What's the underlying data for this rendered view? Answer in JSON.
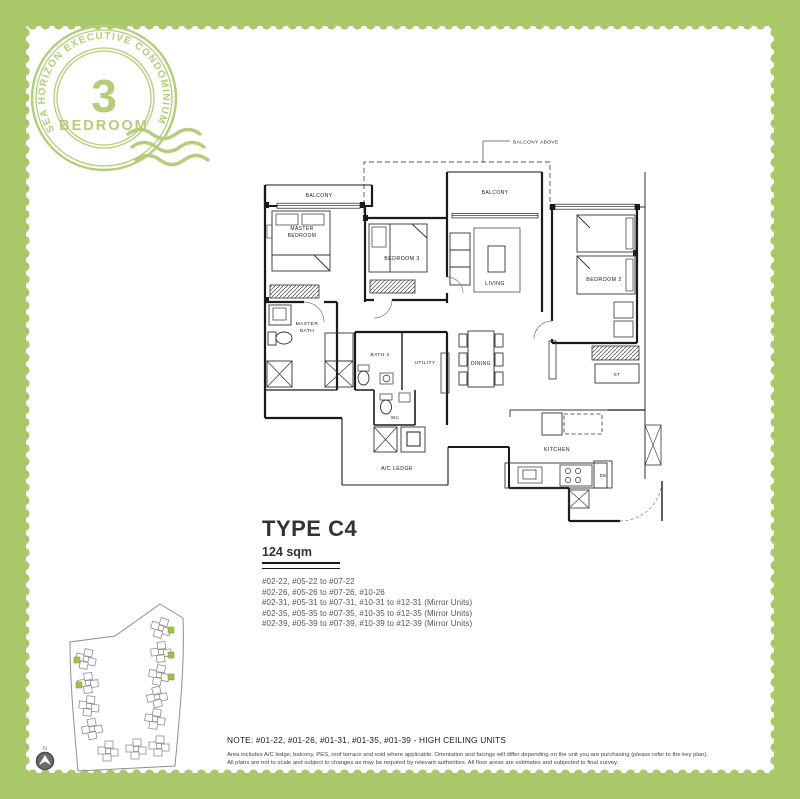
{
  "colors": {
    "frame_green": "#a9c869",
    "stamp_green": "#b3cd7a",
    "plan_line": "#1a1a1a",
    "site_highlight": "#9cc24d"
  },
  "stamp": {
    "arc_text": "SEA HORIZON EXECUTIVE CONDOMINIUM",
    "number": "3",
    "word": "BEDROOM"
  },
  "floorplan": {
    "labels": {
      "balcony_left": "BALCONY",
      "balcony_center": "BALCONY",
      "balcony_above": "BALCONY ABOVE",
      "master_l1": "MASTER",
      "master_l2": "BEDROOM",
      "bedroom3": "BEDROOM 3",
      "living": "LIVING",
      "bedroom2": "BEDROOM 2",
      "masterbath_l1": "MASTER",
      "masterbath_l2": "BATH",
      "bath2": "BATH 2",
      "utility": "UTILITY",
      "wc": "WC",
      "dining": "DINING",
      "st": "ST",
      "kitchen": "KITCHEN",
      "ac_ledge": "A/C  LEDGE",
      "db": "DB"
    }
  },
  "unit_info": {
    "type": "TYPE C4",
    "area": "124 sqm",
    "units": [
      "#02-22, #05-22 to #07-22",
      "#02-26, #05-26 to #07-26, #10-26",
      "#02-31, #05-31 to #07-31, #10-31 to #12-31 (Mirror Units)",
      "#02-35, #05-35 to #07-35, #10-35 to #12-35 (Mirror Units)",
      "#02-39, #05-39 to #07-39, #10-39 to #12-39 (Mirror Units)"
    ]
  },
  "sitemap": {
    "north": "N"
  },
  "note": "NOTE: #01-22, #01-26, #01-31, #01-35, #01-39 - HIGH CEILING UNITS",
  "disclaimer": [
    "Area includes A/C ledge, balcony, PES, roof terrace and void where applicable. Orientation and facings will differ depending on the unit you are purchasing (please refer to the key plan).",
    "All plans are not to scale and subject to changes as may be required by relevant authorities. All floor areas are estimates and subjected to final survey."
  ]
}
